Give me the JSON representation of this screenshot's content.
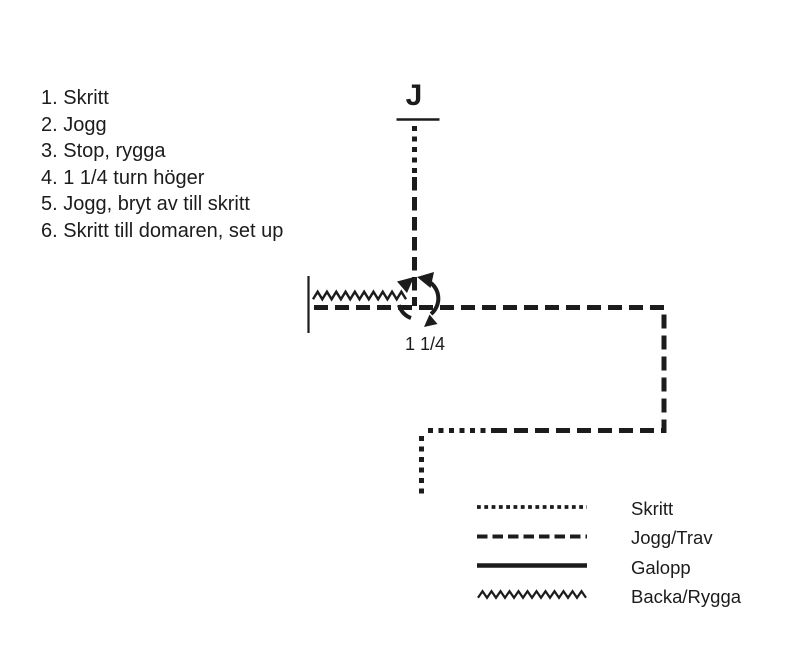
{
  "judge": {
    "label": "J"
  },
  "turn": {
    "label": "1 1/4"
  },
  "instructions": {
    "items": [
      "1. Skritt",
      "2. Jogg",
      "3. Stop, rygga",
      "4. 1 1/4 turn höger",
      "5. Jogg, bryt av till skritt",
      "6. Skritt till domaren, set up"
    ]
  },
  "legend": {
    "items": [
      {
        "label": "Skritt",
        "style": "dotted"
      },
      {
        "label": "Jogg/Trav",
        "style": "dashed"
      },
      {
        "label": "Galopp",
        "style": "solid"
      },
      {
        "label": "Backa/Rygga",
        "style": "zigzag"
      }
    ]
  },
  "colors": {
    "ink": "#1c1c1c",
    "background": "#ffffff"
  }
}
